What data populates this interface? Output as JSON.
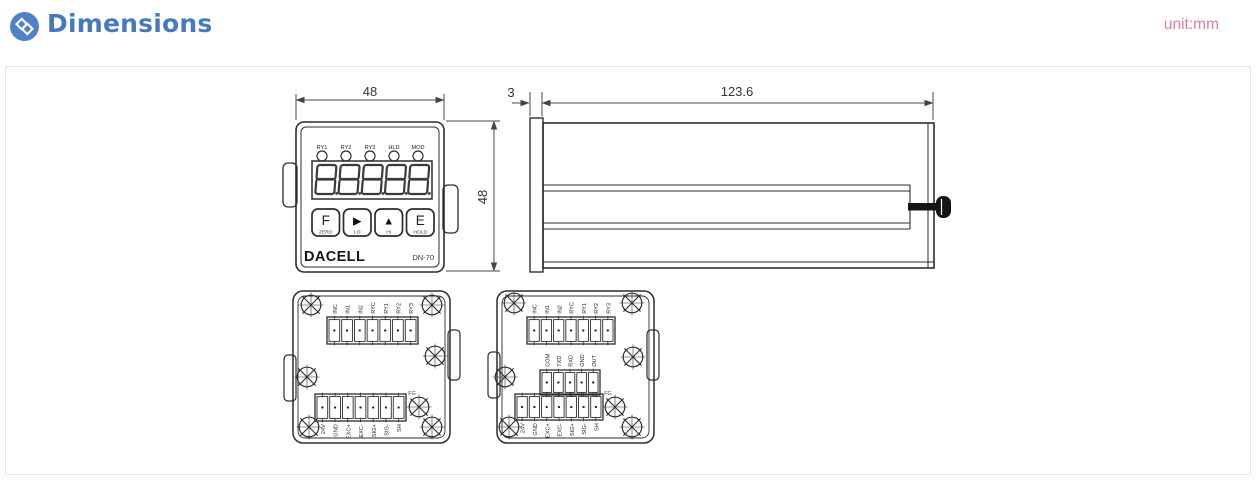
{
  "header": {
    "title": "Dimensions",
    "unit": "unit:mm"
  },
  "colors": {
    "accent": "#4779bd",
    "unit_text": "#e0818f",
    "line": "#2d2d2d"
  },
  "front_view": {
    "top_dim": "48",
    "side_dim": "48",
    "led_labels": [
      "RY1",
      "RY2",
      "RY3",
      "HLD",
      "MOD"
    ],
    "display": "88888",
    "buttons": [
      {
        "key": "F",
        "label": "ZERO"
      },
      {
        "key": "▶",
        "label": "LO"
      },
      {
        "key": "▲",
        "label": "HI"
      },
      {
        "key": "E",
        "label": "HOLD"
      }
    ],
    "brand": "DACELL",
    "model": "DN-70"
  },
  "side_view": {
    "flange_dim": "3",
    "body_dim": "123.6"
  },
  "back_left": {
    "top_terminals": [
      "INC",
      "IN1",
      "IN2",
      "RYC",
      "RY1",
      "RY2",
      "RY3"
    ],
    "bottom_terminals": [
      "24V",
      "GND",
      "EXC+",
      "EXC-",
      "SIG+",
      "SIG-",
      "SH"
    ],
    "fg": "FG"
  },
  "back_right": {
    "top_terminals": [
      "INC",
      "IN1",
      "IN2",
      "RYC",
      "RY1",
      "RY2",
      "RY3"
    ],
    "mid_terminals": [
      "COM",
      "TXD",
      "RXD",
      "GND",
      "OUT"
    ],
    "bottom_terminals": [
      "24V",
      "GND",
      "EXC+",
      "EXC-",
      "SIG+",
      "SIG-",
      "SH"
    ],
    "fg": "FG"
  }
}
